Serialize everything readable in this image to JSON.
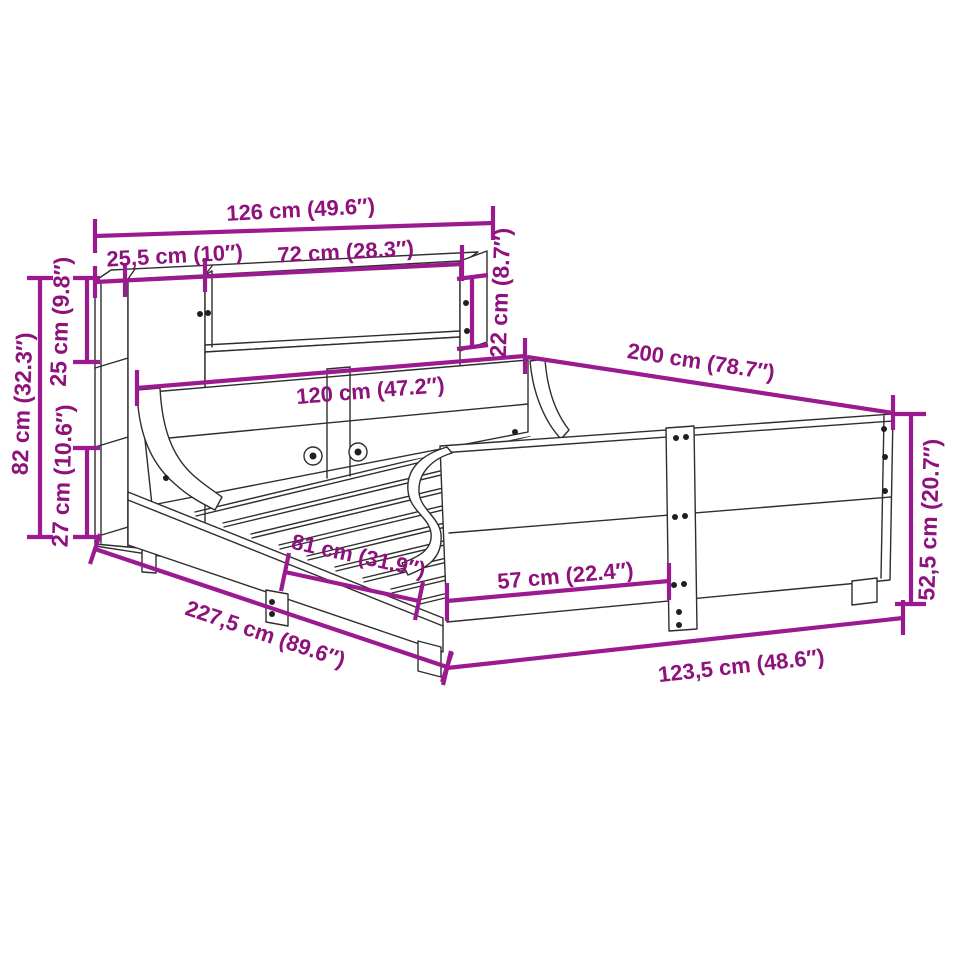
{
  "diagram": {
    "type": "product-dimension-diagram",
    "subject": "wooden bed frame with bookcase sleigh headboard",
    "colors": {
      "dimension_line": "#9c1a8f",
      "dimension_text": "#8e117c",
      "drawing_line": "#2e2e2e"
    },
    "labels": {
      "overall_top_width": "126 cm (49.6″)",
      "left_shelf_width": "25,5 cm (10″)",
      "shelf_opening_width": "72 cm (28.3″)",
      "shelf_opening_height": "22 cm (8.7″)",
      "upper_shelf_height": "25 cm (9.8″)",
      "headboard_total_height": "82 cm (32.3″)",
      "lower_shelf_height": "27 cm (10.6″)",
      "headboard_panel_width": "120 cm (47.2″)",
      "bed_length": "200 cm (78.7″)",
      "footboard_height": "52,5 cm (20.7″)",
      "total_depth": "227,5 cm (89.6″)",
      "side_leg_spacing": "81 cm (31.9″)",
      "front_leg_spacing": "57 cm (22.4″)",
      "front_width": "123,5 cm (48.6″)"
    }
  }
}
